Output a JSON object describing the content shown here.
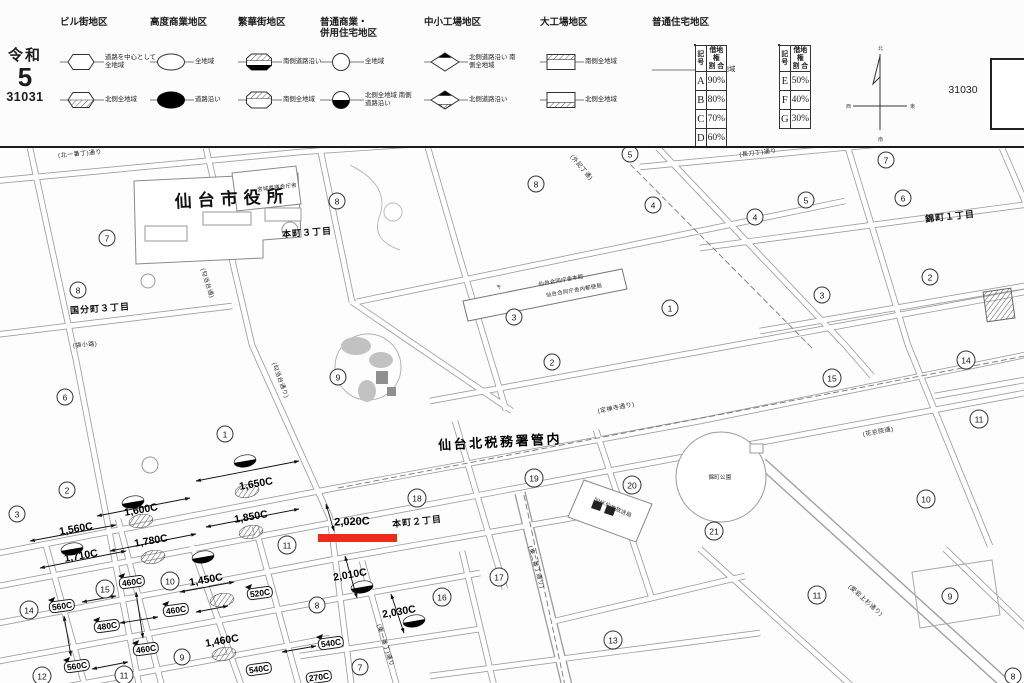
{
  "header": {
    "era_label": "令和",
    "era_year": "5",
    "sheet_number": "31031",
    "adjacent_sheet_number": "31030",
    "compass": {
      "north": "北",
      "south": "南",
      "east": "東",
      "west": "西"
    },
    "legend": {
      "districts": [
        {
          "name": "ビル街地区",
          "rows": [
            {
              "symbol": "hex-plain",
              "label": "道路を中心として全地域"
            },
            {
              "symbol": "hex-hatch-bottom",
              "label": "北側全地域"
            }
          ]
        },
        {
          "name": "高度商業地区",
          "rows": [
            {
              "symbol": "ellipse-plain",
              "label": "全地域"
            },
            {
              "symbol": "ellipse-filled",
              "label": "道路沿い"
            }
          ]
        },
        {
          "name": "繁華街地区",
          "rows": [
            {
              "symbol": "oct-hatch-top-black-bottom",
              "label": "南側道路沿い"
            },
            {
              "symbol": "oct-hatch-top",
              "label": "南側全地域"
            }
          ]
        },
        {
          "name": "普通商業・\n併用住宅地区",
          "rows": [
            {
              "symbol": "circle-plain",
              "label": "全地域"
            },
            {
              "symbol": "circle-black-bottom",
              "label": "北側全地域 南側道路沿い"
            }
          ]
        },
        {
          "name": "中小工場地区",
          "rows": [
            {
              "symbol": "diamond-black-top",
              "label": "北側道路沿い 南側全地域"
            },
            {
              "symbol": "diamond-black-top-hatch-bottom",
              "label": "北側道路沿い"
            }
          ]
        },
        {
          "name": "大工場地区",
          "rows": [
            {
              "symbol": "rect-hatch-top",
              "label": "南側全地域"
            },
            {
              "symbol": "rect-hatch-bottom",
              "label": "北側全地域"
            }
          ]
        },
        {
          "name": "普通住宅地区",
          "rows": [
            {
              "symbol": "plain-line",
              "label": "無印は全地域"
            }
          ]
        }
      ]
    },
    "leasehold_tables": [
      {
        "col1": "記号",
        "col2": "借地権\n割 合",
        "rows": [
          [
            "A",
            "90%"
          ],
          [
            "B",
            "80%"
          ],
          [
            "C",
            "70%"
          ],
          [
            "D",
            "60%"
          ]
        ]
      },
      {
        "col1": "記号",
        "col2": "借地権\n割 合",
        "rows": [
          [
            "E",
            "50%"
          ],
          [
            "F",
            "40%"
          ],
          [
            "G",
            "30%"
          ]
        ]
      }
    ]
  },
  "map": {
    "region_labels": [
      {
        "text": "仙台市役所",
        "x": 232,
        "y": 197,
        "rot": -3,
        "kind": "city-hall"
      },
      {
        "text": "宮城県議会庁舎",
        "x": 277,
        "y": 187,
        "rot": -7,
        "kind": "tiny"
      },
      {
        "text": "国分町３丁目",
        "x": 100,
        "y": 308,
        "rot": -4,
        "kind": "district"
      },
      {
        "text": "本町３丁目",
        "x": 307,
        "y": 232,
        "rot": -4,
        "kind": "district"
      },
      {
        "text": "本町２丁目",
        "x": 417,
        "y": 521,
        "rot": -6,
        "kind": "district"
      },
      {
        "text": "錦町１丁目",
        "x": 950,
        "y": 216,
        "rot": -6,
        "kind": "district"
      },
      {
        "text": "仙台北税務署管内",
        "x": 500,
        "y": 441,
        "rot": -3,
        "kind": "office"
      },
      {
        "text": "錦町公園",
        "x": 720,
        "y": 477,
        "rot": 0,
        "kind": "tiny"
      },
      {
        "text": "NHK仙台放送局",
        "x": 613,
        "y": 507,
        "rot": 25,
        "kind": "tiny"
      },
      {
        "text": "〒",
        "x": 499,
        "y": 287,
        "rot": -11,
        "kind": "tiny"
      },
      {
        "text": "仙台合同庁舎本館",
        "x": 561,
        "y": 280,
        "rot": -10,
        "kind": "tiny"
      },
      {
        "text": "仙台合同庁舎内郵便局",
        "x": 574,
        "y": 290,
        "rot": -10,
        "kind": "tiny"
      }
    ],
    "street_labels": [
      {
        "text": "(北一番丁)通り",
        "x": 80,
        "y": 153,
        "rot": -5
      },
      {
        "text": "(長刀丁)通り",
        "x": 758,
        "y": 152,
        "rot": -6
      },
      {
        "text": "(外記丁通)",
        "x": 582,
        "y": 167,
        "rot": 50
      },
      {
        "text": "(勾当台通)",
        "x": 208,
        "y": 283,
        "rot": 72
      },
      {
        "text": "(勾当台通り)",
        "x": 281,
        "y": 380,
        "rot": 70
      },
      {
        "text": "(袋小路)",
        "x": 85,
        "y": 344,
        "rot": -5
      },
      {
        "text": "(定禅寺通り)",
        "x": 616,
        "y": 407,
        "rot": -11
      },
      {
        "text": "(花京院通)",
        "x": 878,
        "y": 431,
        "rot": -11
      },
      {
        "text": "(東一番丁)通り",
        "x": 386,
        "y": 645,
        "rot": 72
      },
      {
        "text": "(東二番丁通り)",
        "x": 537,
        "y": 567,
        "rot": 74
      },
      {
        "text": "(愛宕上杉通り)",
        "x": 866,
        "y": 600,
        "rot": 42
      }
    ],
    "block_numbers": [
      {
        "n": "7",
        "x": 107,
        "y": 238
      },
      {
        "n": "8",
        "x": 78,
        "y": 290
      },
      {
        "n": "8",
        "x": 337,
        "y": 201
      },
      {
        "n": "8",
        "x": 536,
        "y": 184
      },
      {
        "n": "5",
        "x": 630,
        "y": 154
      },
      {
        "n": "4",
        "x": 653,
        "y": 205
      },
      {
        "n": "3",
        "x": 514,
        "y": 317
      },
      {
        "n": "1",
        "x": 670,
        "y": 308
      },
      {
        "n": "7",
        "x": 886,
        "y": 160
      },
      {
        "n": "5",
        "x": 806,
        "y": 200
      },
      {
        "n": "4",
        "x": 755,
        "y": 217
      },
      {
        "n": "6",
        "x": 903,
        "y": 198
      },
      {
        "n": "2",
        "x": 930,
        "y": 277
      },
      {
        "n": "3",
        "x": 822,
        "y": 295
      },
      {
        "n": "6",
        "x": 65,
        "y": 397
      },
      {
        "n": "1",
        "x": 225,
        "y": 434
      },
      {
        "n": "2",
        "x": 67,
        "y": 490
      },
      {
        "n": "3",
        "x": 17,
        "y": 514
      },
      {
        "n": "9",
        "x": 338,
        "y": 377
      },
      {
        "n": "2",
        "x": 552,
        "y": 362
      },
      {
        "n": "19",
        "x": 534,
        "y": 478
      },
      {
        "n": "18",
        "x": 417,
        "y": 498
      },
      {
        "n": "20",
        "x": 632,
        "y": 485
      },
      {
        "n": "15",
        "x": 832,
        "y": 378
      },
      {
        "n": "14",
        "x": 966,
        "y": 360
      },
      {
        "n": "11",
        "x": 979,
        "y": 419
      },
      {
        "n": "10",
        "x": 926,
        "y": 499
      },
      {
        "n": "21",
        "x": 714,
        "y": 531
      },
      {
        "n": "14",
        "x": 29,
        "y": 610
      },
      {
        "n": "15",
        "x": 105,
        "y": 589
      },
      {
        "n": "10",
        "x": 170,
        "y": 581
      },
      {
        "n": "12",
        "x": 42,
        "y": 676
      },
      {
        "n": "11",
        "x": 124,
        "y": 675
      },
      {
        "n": "9",
        "x": 182,
        "y": 657
      },
      {
        "n": "11",
        "x": 287,
        "y": 545
      },
      {
        "n": "8",
        "x": 317,
        "y": 605
      },
      {
        "n": "7",
        "x": 360,
        "y": 667
      },
      {
        "n": "16",
        "x": 442,
        "y": 597
      },
      {
        "n": "17",
        "x": 499,
        "y": 577
      },
      {
        "n": "13",
        "x": 613,
        "y": 640
      },
      {
        "n": "11",
        "x": 817,
        "y": 595
      },
      {
        "n": "9",
        "x": 950,
        "y": 596
      },
      {
        "n": "8",
        "x": 1013,
        "y": 676
      }
    ],
    "road_values": [
      {
        "value": "1,650C",
        "x": 256,
        "y": 484
      },
      {
        "value": "1,600C",
        "x": 141,
        "y": 510
      },
      {
        "value": "1,850C",
        "x": 251,
        "y": 517
      },
      {
        "value": "1,560C",
        "x": 76,
        "y": 529
      },
      {
        "value": "1,780C",
        "x": 151,
        "y": 541
      },
      {
        "value": "1,710C",
        "x": 81,
        "y": 556
      },
      {
        "value": "2,010C",
        "x": 350,
        "y": 575
      },
      {
        "value": "2,030C",
        "x": 399,
        "y": 612
      },
      {
        "value": "1,450C",
        "x": 206,
        "y": 580
      },
      {
        "value": "1,460C",
        "x": 222,
        "y": 641
      }
    ],
    "corner_values": [
      {
        "value": "560C",
        "x": 62,
        "y": 606
      },
      {
        "value": "460C",
        "x": 132,
        "y": 582
      },
      {
        "value": "480C",
        "x": 107,
        "y": 626
      },
      {
        "value": "460C",
        "x": 176,
        "y": 610
      },
      {
        "value": "460C",
        "x": 146,
        "y": 649
      },
      {
        "value": "560C",
        "x": 77,
        "y": 666
      },
      {
        "value": "520C",
        "x": 260,
        "y": 593
      },
      {
        "value": "540C",
        "x": 331,
        "y": 643
      },
      {
        "value": "540C",
        "x": 259,
        "y": 669
      },
      {
        "value": "270C",
        "x": 319,
        "y": 677
      }
    ],
    "highlight": {
      "value": "2,020C",
      "x": 352,
      "y": 522,
      "color": "#ee2a1c"
    }
  }
}
